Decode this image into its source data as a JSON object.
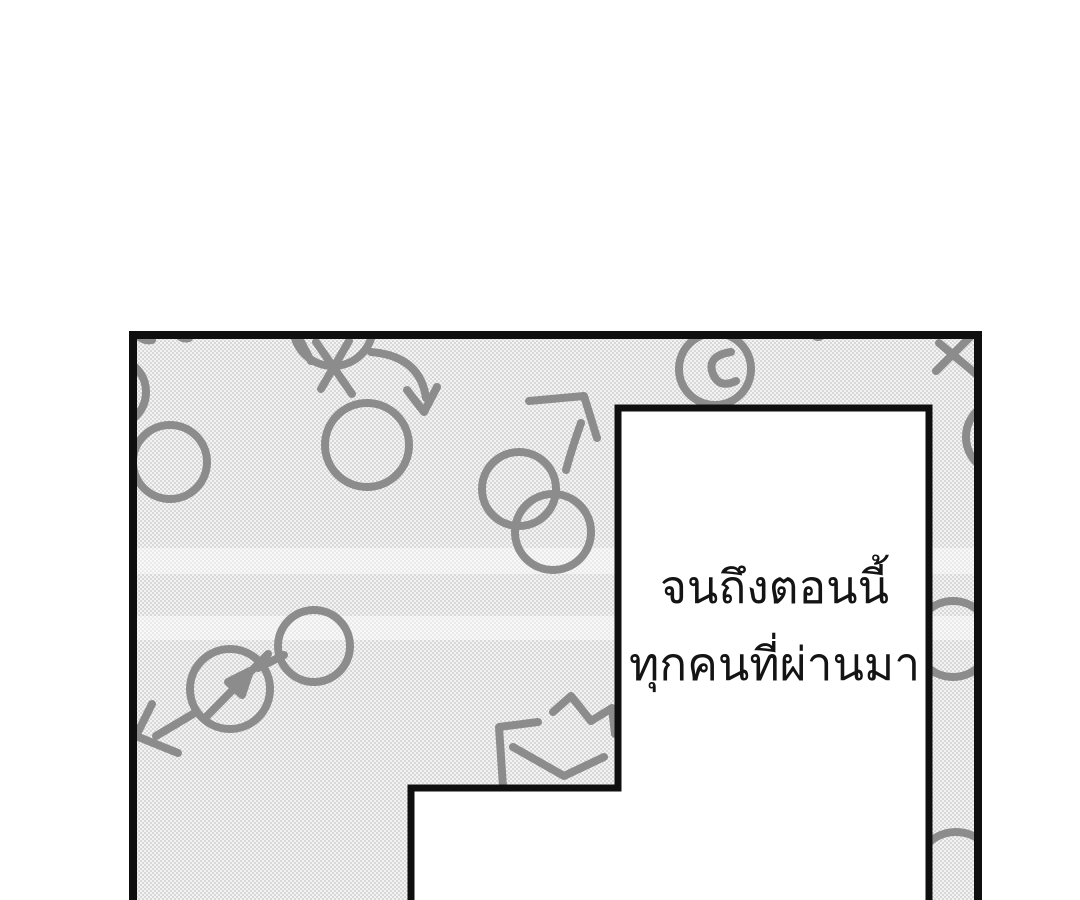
{
  "page": {
    "background": "#ffffff"
  },
  "panel": {
    "kind": "manga-panel",
    "border_color": "#0f0f0f",
    "halftone_base": "#f3f3f3",
    "halftone_dot": "#d0d0d0",
    "band_color": "rgba(255,255,255,0.45)",
    "doodle_color": "#8c8c8c"
  },
  "speech": {
    "line1": "จนถึงตอนนี้",
    "line2": "ทุกคนที่ผ่านมา",
    "text_color": "#141414"
  },
  "artwork": {
    "description": "hand-drawn circle and arrow doodles scattered over a halftone screentone background",
    "doodles": [
      {
        "kind": "circle",
        "cx": 170,
        "cy": 462,
        "r": 37
      },
      {
        "kind": "circle",
        "cx": 112,
        "cy": 392,
        "r": 34
      },
      {
        "kind": "path",
        "d": "M135,333 q8,9 17,7"
      },
      {
        "kind": "path",
        "d": "M176,333 q6,7 13,5"
      },
      {
        "kind": "circle",
        "cx": 367,
        "cy": 445,
        "r": 42
      },
      {
        "kind": "circle",
        "cx": 333,
        "cy": 326,
        "r": 40
      },
      {
        "kind": "path",
        "d": "M299,338 L311,361"
      },
      {
        "kind": "path",
        "d": "M316,342 L352,394"
      },
      {
        "kind": "path",
        "d": "M349,341 L321,389"
      },
      {
        "kind": "path",
        "d": "M371,352 Q420,356 426,398"
      },
      {
        "kind": "path",
        "d": "M407,390 L424,412 L437,387"
      },
      {
        "kind": "circle",
        "cx": 715,
        "cy": 369,
        "r": 36
      },
      {
        "kind": "path",
        "d": "M731,352 Q706,356 713,374 Q719,389 736,381"
      },
      {
        "kind": "circle",
        "cx": 818,
        "cy": 332,
        "r": 5
      },
      {
        "kind": "circle",
        "cx": 519,
        "cy": 489,
        "r": 37
      },
      {
        "kind": "circle",
        "cx": 553,
        "cy": 532,
        "r": 38
      },
      {
        "kind": "path",
        "d": "M529,401 L584,396 L597,438"
      },
      {
        "kind": "path",
        "d": "M581,423 Q572,448 566,470"
      },
      {
        "kind": "path",
        "d": "M939,343 L976,374"
      },
      {
        "kind": "path",
        "d": "M971,336 L936,371"
      },
      {
        "kind": "circle",
        "cx": 1002,
        "cy": 437,
        "r": 36
      },
      {
        "kind": "circle",
        "cx": 953,
        "cy": 639,
        "r": 38
      },
      {
        "kind": "circle",
        "cx": 956,
        "cy": 872,
        "r": 40
      },
      {
        "kind": "circle",
        "cx": 230,
        "cy": 689,
        "r": 40
      },
      {
        "kind": "circle",
        "cx": 314,
        "cy": 646,
        "r": 36
      },
      {
        "kind": "path",
        "d": "M258,668 L284,655"
      },
      {
        "kind": "path",
        "d": "M207,716 L268,654"
      },
      {
        "kind": "path",
        "d": "M228,682 L250,671 L242,695 Z",
        "fill": true
      },
      {
        "kind": "path",
        "d": "M193,714 L156,736"
      },
      {
        "kind": "path",
        "d": "M152,704 L136,736 L178,753"
      },
      {
        "kind": "path",
        "d": "M503,787 L499,727 L538,722"
      },
      {
        "kind": "path",
        "d": "M513,747 L564,776 L604,757"
      },
      {
        "kind": "path",
        "d": "M553,712 L571,696 L591,721 L612,708 L615,734"
      }
    ]
  }
}
